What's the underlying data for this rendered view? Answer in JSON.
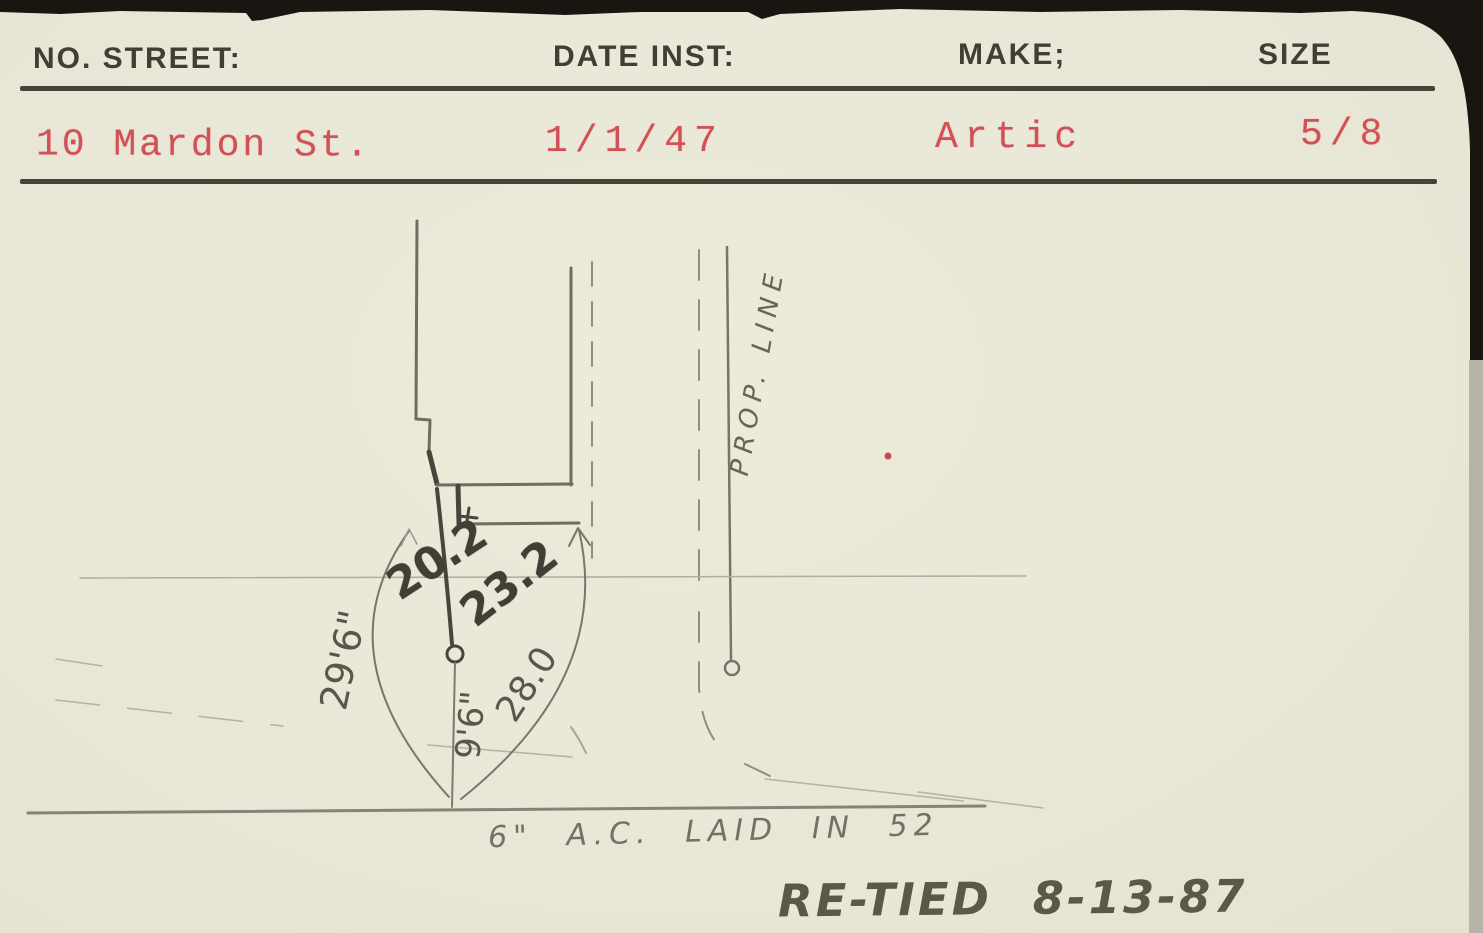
{
  "header": {
    "fields": [
      {
        "label": "NO. STREET:",
        "value": "10 Mardon St."
      },
      {
        "label": "DATE INST:",
        "value": "1/1/47"
      },
      {
        "label": "MAKE;",
        "value": "Artic"
      },
      {
        "label": "SIZE",
        "value": "5/8"
      }
    ]
  },
  "sketch": {
    "measurements": {
      "service_length": "20.2",
      "tie_right": "23.2",
      "tie_left": "29'6\"",
      "offset_center": "9'6\"",
      "tie_far": "28.0"
    },
    "labels": {
      "prop_line": "PROP. LINE",
      "water_main_note": "6\" A.C. LAID IN 52",
      "re_tied_note": "RE-TIED 8-13-87"
    },
    "colors": {
      "typed_red": "#d25156",
      "ink": "#403f36",
      "pencil": "#7b7b6e",
      "pencil_dark": "#46463c",
      "card": "#eae8da"
    }
  }
}
